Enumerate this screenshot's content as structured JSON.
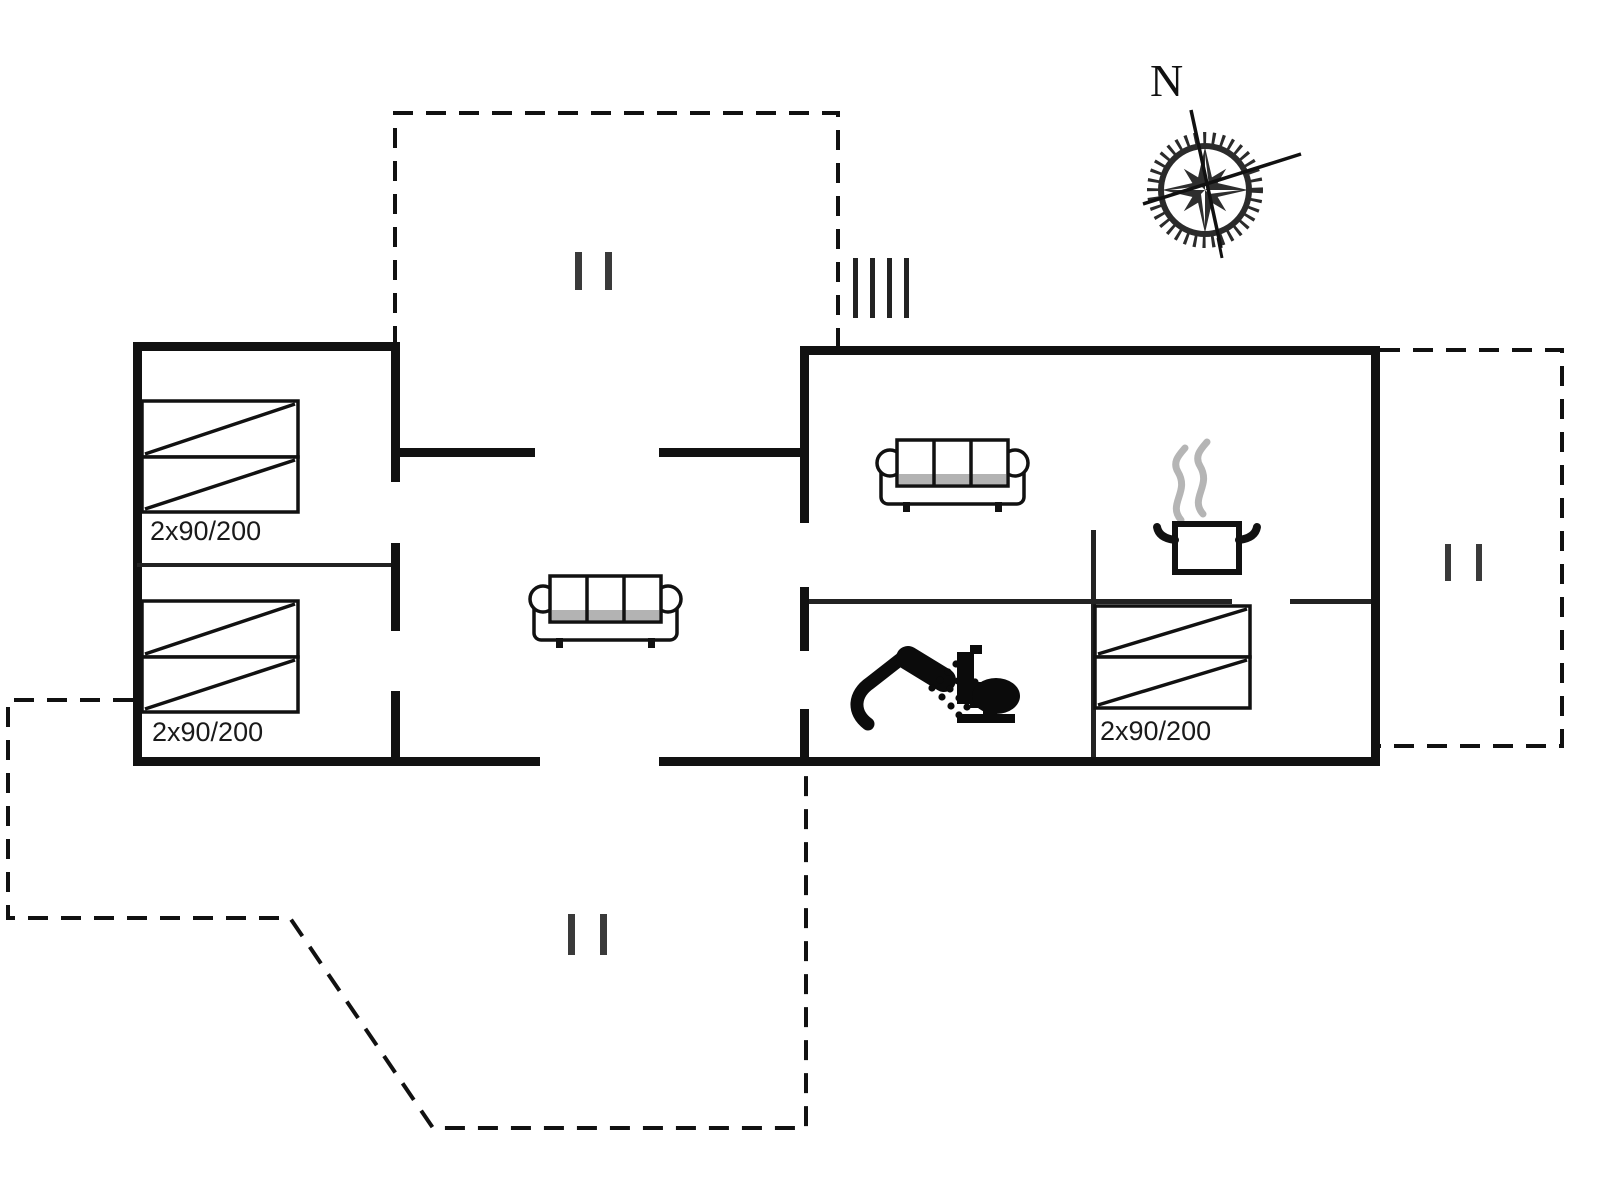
{
  "document": {
    "type": "floor-plan",
    "background": "#ffffff"
  },
  "compass": {
    "label": "N"
  },
  "beds": [
    {
      "id": "bed-1",
      "room": "left-bedroom-top",
      "label": "2x90/200"
    },
    {
      "id": "bed-2",
      "room": "left-bedroom-bottom",
      "label": "2x90/200"
    },
    {
      "id": "bed-3",
      "room": "right-bedroom",
      "label": "2x90/200"
    }
  ],
  "icons": {
    "compass": "compass-rose-icon",
    "sofa": "sofa-icon",
    "bed": "double-bed-icon",
    "kitchen": "steaming-pot-icon",
    "shower": "shower-icon",
    "toilet": "toilet-icon",
    "steps": "entrance-steps-icon",
    "door_marker": "terrace-door-marker-icon"
  },
  "colors": {
    "wall": "#111111",
    "interior_wall": "#222222",
    "terrace_dash": "#111111",
    "steam": "#b5b5b5",
    "text": "#1a1a1a",
    "background": "#ffffff"
  }
}
